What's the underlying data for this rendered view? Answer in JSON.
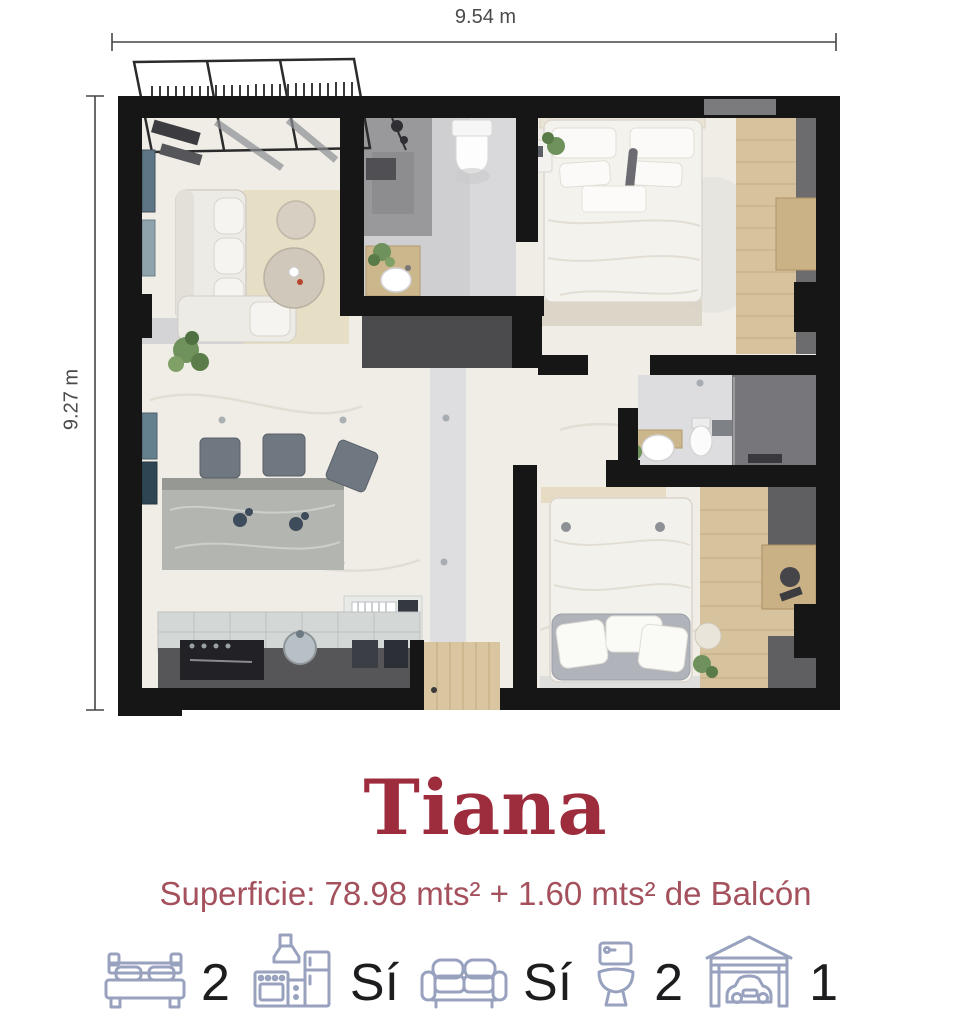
{
  "dimensions": {
    "width_label": "9.54 m",
    "height_label": "9.27 m"
  },
  "title": "Tiana",
  "surface_label": "Superficie: 78.98 mts² + 1.60 mts² de Balcón",
  "features": [
    {
      "name": "bedrooms",
      "icon": "bed-icon",
      "value": "2"
    },
    {
      "name": "kitchen",
      "icon": "kitchen-icon",
      "value": "Sí"
    },
    {
      "name": "living",
      "icon": "sofa-icon",
      "value": "Sí"
    },
    {
      "name": "bathrooms",
      "icon": "toilet-icon",
      "value": "2"
    },
    {
      "name": "parking",
      "icon": "garage-icon",
      "value": "1"
    }
  ],
  "colors": {
    "title": "#9d2c3c",
    "subtitle": "#a4515d",
    "icon_stroke": "#98a2bf",
    "value": "#1d1d1f",
    "dim": "#4a4a4a",
    "wall": "#161616"
  }
}
